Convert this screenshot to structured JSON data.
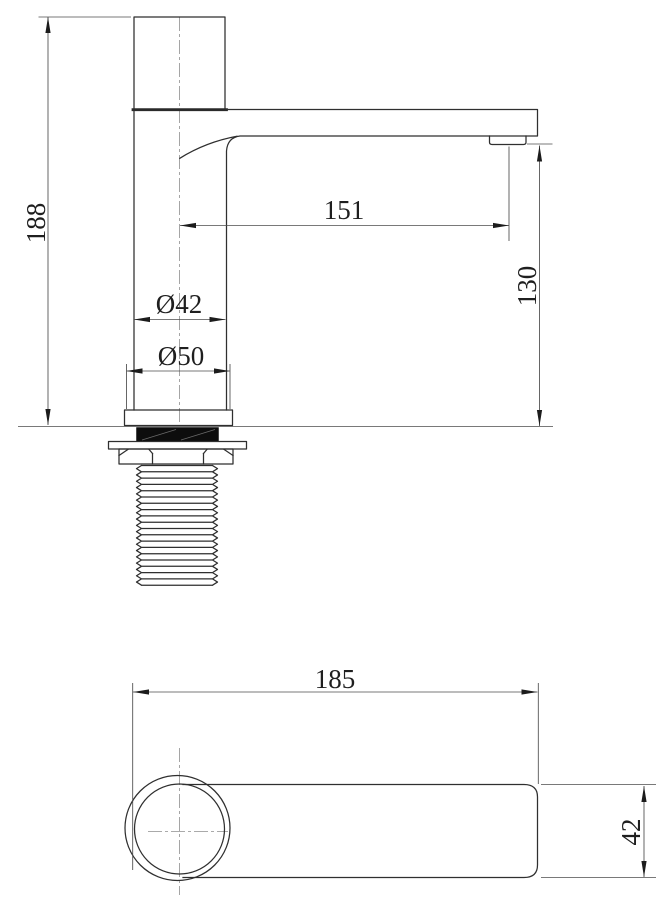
{
  "dimensions": {
    "side_view": {
      "overall_height": "188",
      "spout_reach": "151",
      "spout_outlet_height": "130",
      "body_diameter": "Ø42",
      "base_diameter": "Ø50"
    },
    "top_view": {
      "overall_length": "185",
      "spout_width": "42"
    }
  },
  "style": {
    "background": "#ffffff",
    "line_color": "#2f2f2f",
    "dim_line_color": "#4c4c4c"
  }
}
